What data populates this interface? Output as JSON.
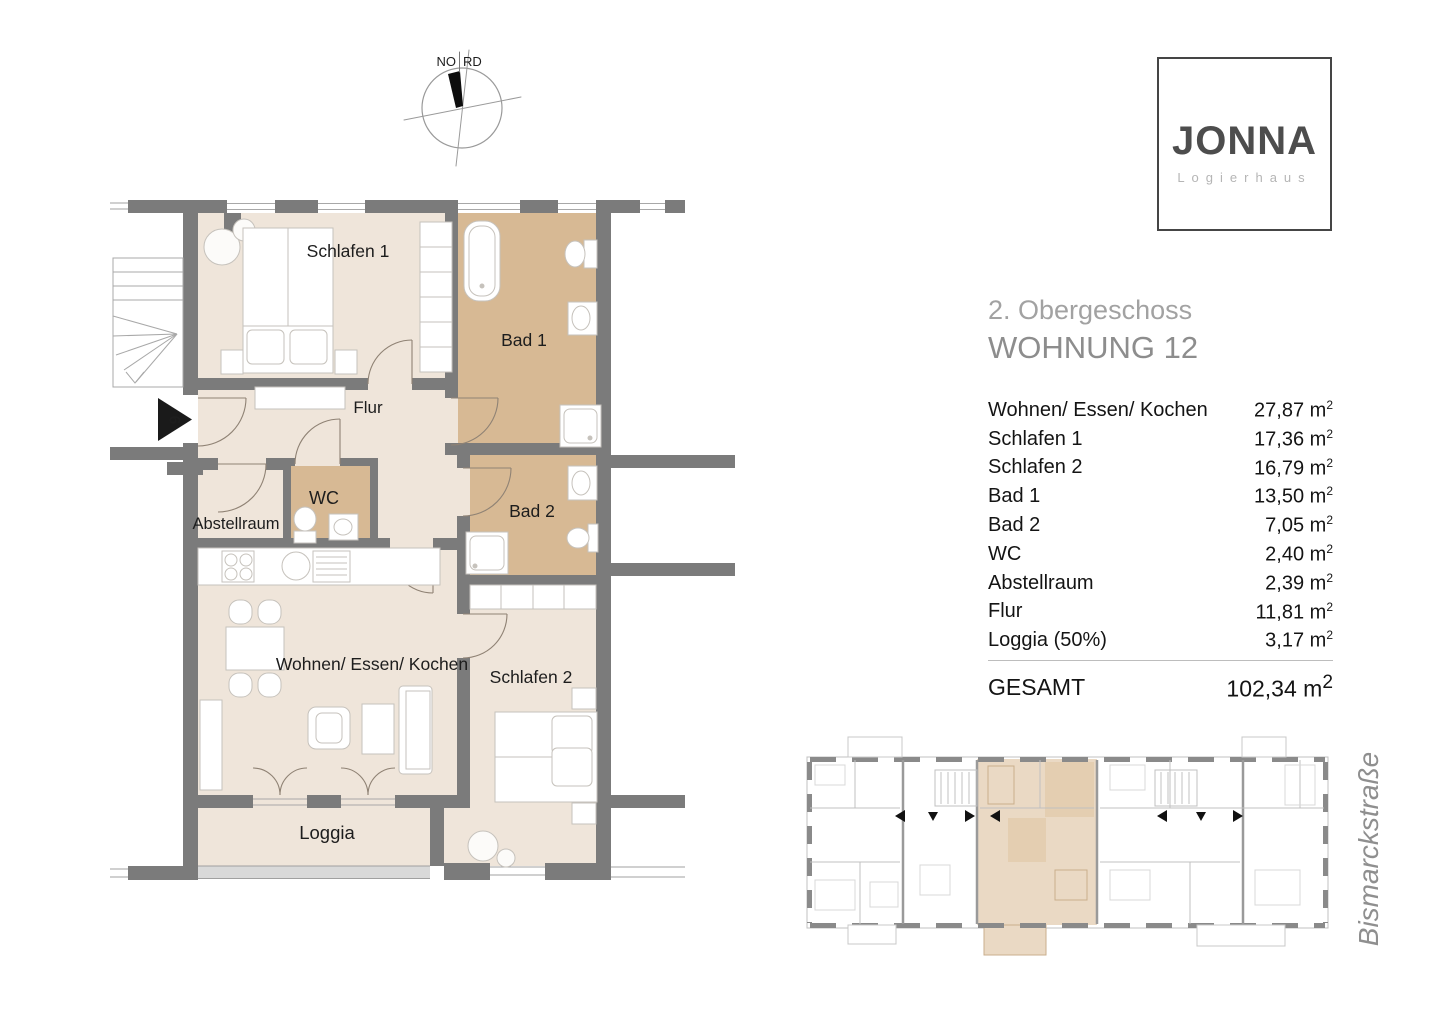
{
  "header": {
    "floor": "2. Obergeschoss",
    "unit": "WOHNUNG 12"
  },
  "logo": {
    "name": "JONNA",
    "subtitle": "Logierhaus"
  },
  "compass": {
    "left": "NO",
    "right": "RD"
  },
  "entrance": {
    "number": "6"
  },
  "plan": {
    "labels": {
      "schlafen1": "Schlafen 1",
      "bad1": "Bad 1",
      "flur": "Flur",
      "wc": "WC",
      "abstellraum": "Abstellraum",
      "bad2": "Bad 2",
      "wohnen": "Wohnen/ Essen/ Kochen",
      "schlafen2": "Schlafen 2",
      "loggia": "Loggia"
    }
  },
  "areas": {
    "rows": [
      {
        "label": "Wohnen/ Essen/ Kochen",
        "value": "27,87"
      },
      {
        "label": "Schlafen 1",
        "value": "17,36"
      },
      {
        "label": "Schlafen 2",
        "value": "16,79"
      },
      {
        "label": "Bad 1",
        "value": "13,50"
      },
      {
        "label": "Bad 2",
        "value": "7,05"
      },
      {
        "label": "WC",
        "value": "2,40"
      },
      {
        "label": "Abstellraum",
        "value": "2,39"
      },
      {
        "label": "Flur",
        "value": "11,81"
      },
      {
        "label": "Loggia (50%)",
        "value": "3,17"
      }
    ],
    "unit_base": "m",
    "unit_exp": "2",
    "total_label": "GESAMT",
    "total_value": "102,34"
  },
  "street": {
    "name": "Bismarckstraße"
  },
  "colors": {
    "floor_beige": "#efe5da",
    "wet_tan": "#d7b994",
    "wall_gray": "#7b7b7b",
    "highlight_beige": "#ead9c4",
    "accent_text_gray": "#8d8d8d"
  }
}
